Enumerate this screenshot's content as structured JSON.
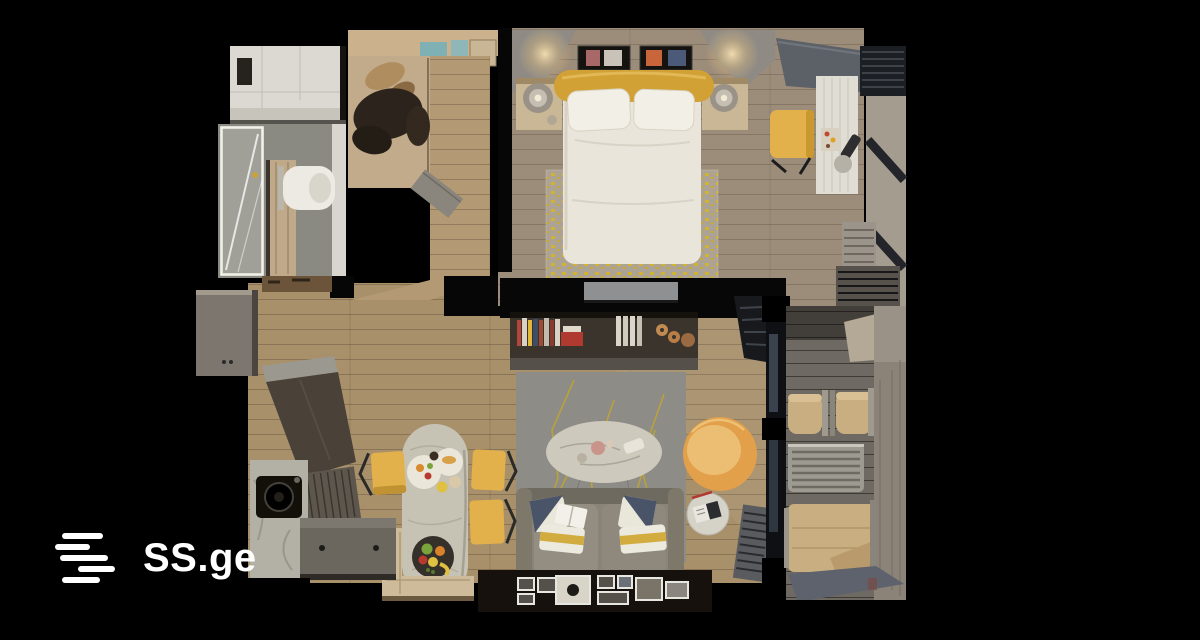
{
  "watermark": {
    "brand": "SS.ge"
  },
  "scene": {
    "description": "Top-down 3D render of a one-bedroom apartment floor plan on a black background",
    "rooms": [
      {
        "name": "bathroom"
      },
      {
        "name": "wardrobe-hall"
      },
      {
        "name": "bedroom"
      },
      {
        "name": "workspace"
      },
      {
        "name": "kitchen"
      },
      {
        "name": "dining-area"
      },
      {
        "name": "living-room"
      },
      {
        "name": "balcony"
      }
    ],
    "furniture": [
      "shower",
      "toilet",
      "wardrobe-clothes",
      "double-bed",
      "pillows",
      "yellow-blanket",
      "nightstands",
      "table-lamps",
      "wall-art",
      "bedroom-rug",
      "desk",
      "desk-chair",
      "window-blinds",
      "radiator",
      "tv-panel",
      "bookshelf",
      "living-rug",
      "coffee-table",
      "yellow-armchair",
      "sofa",
      "sofa-cushions",
      "side-table",
      "dining-table",
      "dining-chairs",
      "corner-bench",
      "fruit-bowl",
      "kitchen-cabinet",
      "kitchen-counter",
      "sink",
      "picture-frames",
      "balcony-chairs",
      "balcony-table",
      "lounger"
    ]
  },
  "colors": {
    "background": "#000000",
    "bedroom_floor": "#9c8c7a",
    "living_floor": "#a8906b",
    "hall_wood": "#b49a74",
    "wardrobe_wood": "#c2ab8a",
    "balcony_floor": "#6e6962",
    "bath_tile": "#dcd9d2",
    "bath_floor": "#8b8a82",
    "door_tan": "#c0a988",
    "bed_white": "#eae5da",
    "pillow_white": "#f2efe6",
    "blanket_yellow": "#d2a136",
    "rug_bed_base": "#ada394",
    "rug_living_base": "#8d8c86",
    "sofa_gray": "#8a8478",
    "chair_yellow": "#e3b14b",
    "armchair_yellow": "#e2a04b",
    "armchair_inner": "#ecbe74",
    "marble_light": "#cdc9bd",
    "dining_marble": "#c6c2b4",
    "counter_gray": "#6b665e",
    "counter_dark": "#4a4138",
    "cabinet_gray": "#7d766e",
    "balcony_tan": "#c9ae82",
    "teal_accent": "#7fb0b4",
    "tv_gray": "#8f9092",
    "shelf_dark": "#3a342d",
    "wall_beige": "#a59c90",
    "glass_gray": "#39424d",
    "headboard_gray": "#8f8b84",
    "frame_white": "#e8e6e0",
    "logo_white": "#ffffff"
  }
}
